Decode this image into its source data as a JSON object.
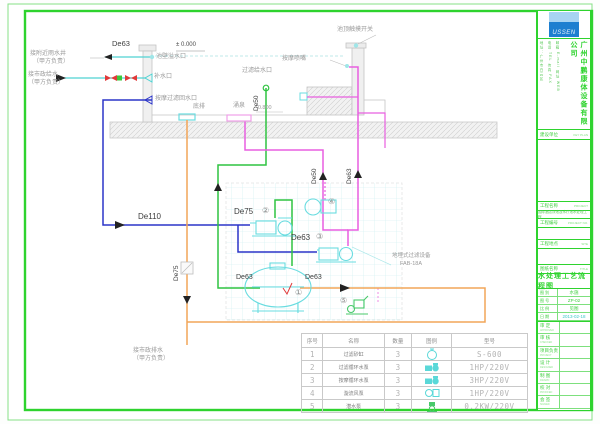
{
  "accent_colors": {
    "frame_green": "#2ed32e",
    "pipe_blue": "#2b35c8",
    "pipe_green": "#2fc441",
    "pipe_magenta": "#e85fe0",
    "pipe_orange": "#f2a558",
    "equipment_cyan": "#6adce0",
    "valve_red": "#e03a3a"
  },
  "drawing": {
    "labels": [
      {
        "n": "label-rain-well",
        "t": "接附近雨水井",
        "x": 30,
        "y": 51,
        "c": "#9a9a9a",
        "fs": 6
      },
      {
        "n": "label-rain-well-2",
        "t": "（甲方负责）",
        "x": 33,
        "y": 59,
        "c": "#9a9a9a",
        "fs": 6
      },
      {
        "n": "label-city-water",
        "t": "接市政给水",
        "x": 28,
        "y": 72,
        "c": "#9a9a9a",
        "fs": 6
      },
      {
        "n": "label-city-water-2",
        "t": "（甲方负责）",
        "x": 28,
        "y": 80,
        "c": "#9a9a9a",
        "fs": 6
      },
      {
        "n": "pipe-label-de63-overflow",
        "t": "De63",
        "x": 112,
        "y": 40,
        "c": "#3d3d3d",
        "fs": 7.5
      },
      {
        "n": "level-label-zero",
        "t": "± 0.000",
        "x": 176,
        "y": 42,
        "c": "#4a4a4a",
        "fs": 6
      },
      {
        "n": "label-overflow-port",
        "t": "池壁溢水口",
        "x": 156,
        "y": 54,
        "c": "#9a9a9a",
        "fs": 6
      },
      {
        "n": "label-refill-port",
        "t": "补水口",
        "x": 154,
        "y": 74,
        "c": "#9a9a9a",
        "fs": 6
      },
      {
        "n": "label-return-port",
        "t": "按摩过滤回水口",
        "x": 155,
        "y": 96,
        "c": "#9a9a9a",
        "fs": 6
      },
      {
        "n": "label-bottom-drain",
        "t": "底排",
        "x": 193,
        "y": 104,
        "c": "#9a9a9a",
        "fs": 6
      },
      {
        "n": "label-filter-supply-port",
        "t": "过滤给水口",
        "x": 242,
        "y": 68,
        "c": "#9a9a9a",
        "fs": 6
      },
      {
        "n": "label-fountain",
        "t": "涌泉",
        "x": 233,
        "y": 103,
        "c": "#9a9a9a",
        "fs": 6
      },
      {
        "n": "level-label-minus-0800",
        "t": "-0.800",
        "x": 256,
        "y": 106,
        "c": "#9a9a9a",
        "fs": 5.5
      },
      {
        "n": "pipe-label-de50-riser",
        "t": "De50",
        "x": 254,
        "y": 111,
        "c": "#3d3d3d",
        "fs": 6.5,
        "r": -90
      },
      {
        "n": "label-massage-nozzle",
        "t": "按摩喷嘴",
        "x": 282,
        "y": 56,
        "c": "#9a9a9a",
        "fs": 6
      },
      {
        "n": "label-touch-switch",
        "t": "池顶触摸开关",
        "x": 337,
        "y": 27,
        "c": "#9a9a9a",
        "fs": 6
      },
      {
        "n": "pipe-label-de110",
        "t": "De110",
        "x": 138,
        "y": 213,
        "c": "#3d3d3d",
        "fs": 8
      },
      {
        "n": "pipe-label-de75-pump2",
        "t": "De75",
        "x": 234,
        "y": 208,
        "c": "#3d3d3d",
        "fs": 8
      },
      {
        "n": "equip-num-2",
        "t": "②",
        "x": 262,
        "y": 207,
        "c": "#8a8a8a",
        "fs": 8
      },
      {
        "n": "pipe-label-de63-pump3",
        "t": "De63",
        "x": 291,
        "y": 234,
        "c": "#3d3d3d",
        "fs": 8
      },
      {
        "n": "equip-num-3",
        "t": "③",
        "x": 316,
        "y": 233,
        "c": "#8a8a8a",
        "fs": 8
      },
      {
        "n": "equip-num-4",
        "t": "④",
        "x": 328,
        "y": 198,
        "c": "#8a8a8a",
        "fs": 8
      },
      {
        "n": "equip-num-1",
        "t": "①",
        "x": 295,
        "y": 289,
        "c": "#8a8a8a",
        "fs": 8
      },
      {
        "n": "equip-num-5",
        "t": "⑤",
        "x": 340,
        "y": 297,
        "c": "#8a8a8a",
        "fs": 8
      },
      {
        "n": "pipe-label-de63-filter-in",
        "t": "De63",
        "x": 236,
        "y": 274,
        "c": "#3d3d3d",
        "fs": 7
      },
      {
        "n": "pipe-label-de63-waste",
        "t": "De63",
        "x": 305,
        "y": 274,
        "c": "#3d3d3d",
        "fs": 7
      },
      {
        "n": "pipe-label-de50-fountain-riser",
        "t": "De50",
        "x": 312,
        "y": 184,
        "c": "#3d3d3d",
        "fs": 6.5,
        "r": -90
      },
      {
        "n": "pipe-label-de63-nozzle-riser",
        "t": "De63",
        "x": 347,
        "y": 184,
        "c": "#3d3d3d",
        "fs": 6.5,
        "r": -90
      },
      {
        "n": "pipe-label-de75-drain",
        "t": "De75",
        "x": 174,
        "y": 281,
        "c": "#3d3d3d",
        "fs": 6.5,
        "r": -90
      },
      {
        "n": "label-city-drain",
        "t": "接市政排水",
        "x": 133,
        "y": 348,
        "c": "#9a9a9a",
        "fs": 6
      },
      {
        "n": "label-city-drain-2",
        "t": "（甲方负责）",
        "x": 133,
        "y": 356,
        "c": "#9a9a9a",
        "fs": 6
      },
      {
        "n": "label-buried-filter",
        "t": "地埋式过滤设备",
        "x": 392,
        "y": 254,
        "c": "#9a9a9a",
        "fs": 5.5
      },
      {
        "n": "label-buried-filter-model",
        "t": "FAB-18A",
        "x": 400,
        "y": 262,
        "c": "#9a9a9a",
        "fs": 5.5
      }
    ]
  },
  "equipment_table": {
    "headers": [
      "序号",
      "名称",
      "数量",
      "图例",
      "型号"
    ],
    "rows": [
      {
        "no": "1",
        "name": "过滤砂缸",
        "qty": "3",
        "icon": "filter-tank-icon",
        "model": "S-600"
      },
      {
        "no": "2",
        "name": "过滤循环水泵",
        "qty": "3",
        "icon": "pump-icon",
        "model": "1HP/220V"
      },
      {
        "no": "3",
        "name": "按摩循环水泵",
        "qty": "3",
        "icon": "pump-icon",
        "model": "3HP/220V"
      },
      {
        "no": "4",
        "name": "漩流风泵",
        "qty": "3",
        "icon": "blower-icon",
        "model": "1HP/220V"
      },
      {
        "no": "5",
        "name": "潜水泵",
        "qty": "3",
        "icon": "submersible-pump-icon",
        "model": "0.2KW/220V"
      }
    ]
  },
  "titleblock": {
    "logo_text": "USSEN",
    "company_name": "广州中鹏康体设备有限公司",
    "company_info": [
      "地址：广州市白云区",
      "电话 TEL 传真 FAX",
      "邮箱 E-mail 网址 WEB"
    ],
    "owner_label": "建设单位",
    "owner_en": "KEY PLAN",
    "fields": [
      {
        "key": "project-name",
        "label": "工程名称",
        "en": "PROJECT",
        "value": "国际酒店泳池及水疗池水处理工程",
        "vh": 8
      },
      {
        "key": "project-no",
        "label": "工程编号",
        "en": "PROJECT NO.",
        "value": "",
        "vh": 12
      },
      {
        "key": "site",
        "label": "工程地点",
        "en": "SITE",
        "value": "",
        "vh": 16
      }
    ],
    "title_label": "图纸名称",
    "title_en": "TITLE",
    "drawing_title": "水处理工艺流程图",
    "meta": [
      {
        "key": "category",
        "label": "图 别",
        "value": "水施",
        "vc": "#3fcf3f"
      },
      {
        "key": "number",
        "label": "图 号",
        "value": "ZP-02",
        "vc": "#3fcf3f"
      },
      {
        "key": "scale",
        "label": "比 例",
        "value": "见图",
        "vc": "#3fcf3f"
      },
      {
        "key": "date",
        "label": "日 期",
        "value": "2013-02-18",
        "vc": "#3cc8c8"
      }
    ],
    "signs": [
      {
        "key": "approved",
        "label": "审 定",
        "en": "APPROVED"
      },
      {
        "key": "checked",
        "label": "审 核",
        "en": "CHECKED"
      },
      {
        "key": "project-head",
        "label": "项目负责",
        "en": "PROJECT"
      },
      {
        "key": "designed",
        "label": "设 计",
        "en": "DESIGNED"
      },
      {
        "key": "drawn",
        "label": "制 图",
        "en": "DRAWN"
      },
      {
        "key": "proofed",
        "label": "校 对",
        "en": "PROOFED"
      },
      {
        "key": "countersign",
        "label": "会 签",
        "en": "SIGNED"
      }
    ]
  }
}
